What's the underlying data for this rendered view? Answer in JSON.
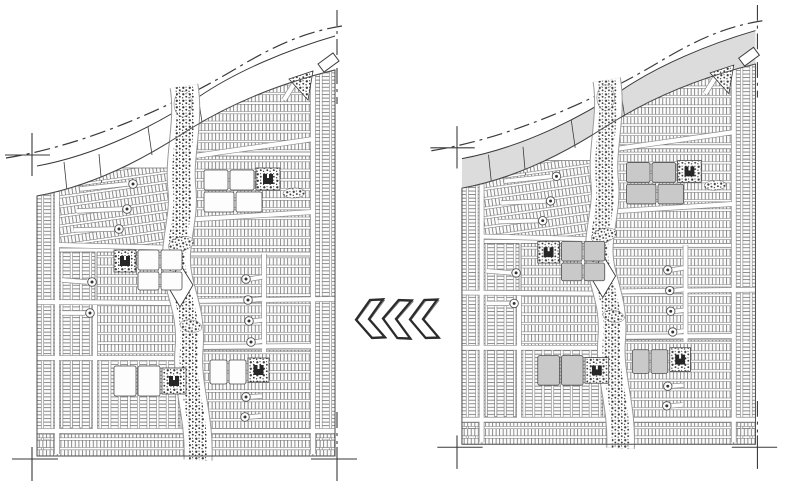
{
  "figure": {
    "type": "site-plan-comparison",
    "background_color": "#ffffff",
    "ink_color": "#3a3a3a",
    "street_casing_color": "#8f8f8f",
    "lot_hatch_color": "#6f6f6f",
    "vegetation_color": "#383838",
    "panels": [
      {
        "id": "left-plan",
        "position": "left",
        "variant": "outline",
        "band_fill": "#ffffff",
        "big_block_fill": "#fdfdfd",
        "cul_de_sac_dot": true
      },
      {
        "id": "right-plan",
        "position": "right",
        "variant": "shaded",
        "band_fill": "#dcdcdc",
        "big_block_fill": "#c9c9c9",
        "cul_de_sac_dot": true
      }
    ],
    "features": [
      "curved-arterial-parkway",
      "dash-dot-property-line",
      "corner-survey-ticks",
      "residential-lot-blocks",
      "perimeter-lot-strips",
      "central-greenway-corridor",
      "pond-diamond",
      "civic-blocks",
      "building-icons",
      "cul-de-sacs",
      "highway-entry-parallelogram",
      "vegetation-triangle"
    ],
    "chevrons": {
      "count": 3,
      "direction": "left",
      "stroke": "#2b2b2b",
      "fill": "#ffffff"
    }
  }
}
